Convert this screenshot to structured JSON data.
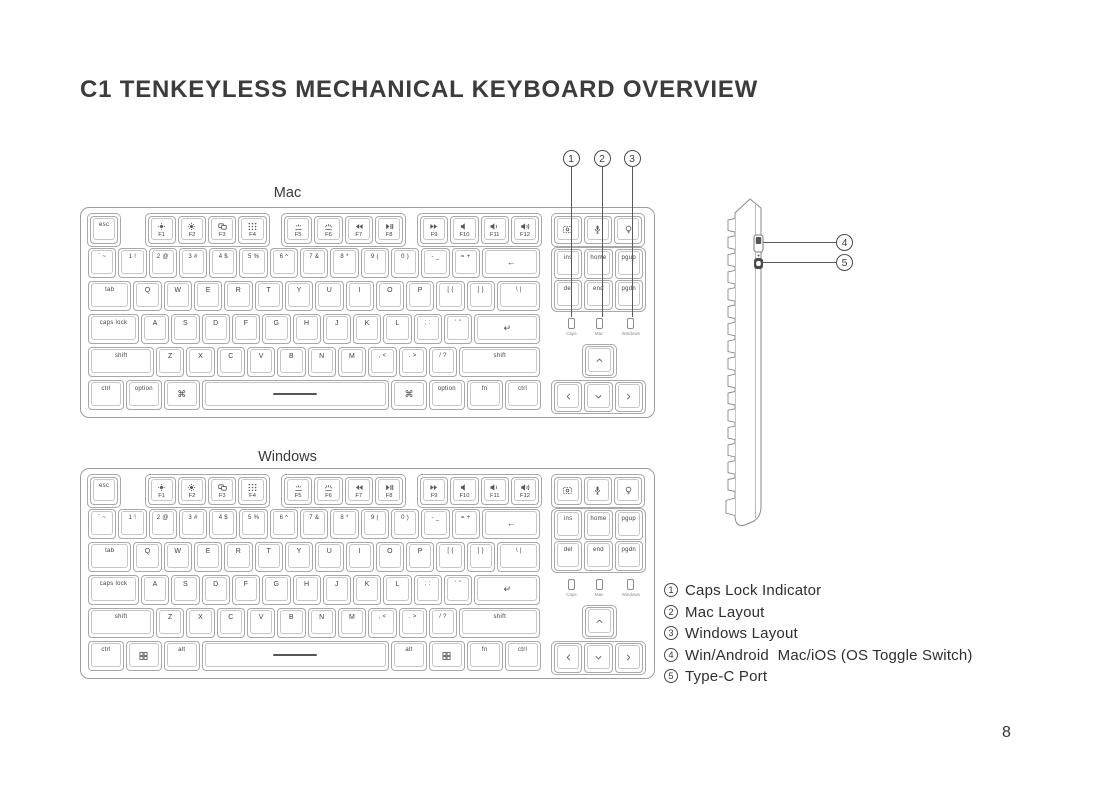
{
  "title": "C1 TENKEYLESS MECHANICAL KEYBOARD OVERVIEW",
  "page_number": "8",
  "callouts": {
    "top": [
      "1",
      "2",
      "3"
    ],
    "side": [
      "4",
      "5"
    ]
  },
  "legend": [
    {
      "num": "1",
      "text": "Caps Lock Indicator"
    },
    {
      "num": "2",
      "text": "Mac Layout"
    },
    {
      "num": "3",
      "text": "Windows Layout"
    },
    {
      "num": "4",
      "text": "Win/Android  Mac/iOS (OS Toggle Switch)"
    },
    {
      "num": "5",
      "text": "Type-C Port"
    }
  ],
  "side_view": {
    "parts": [
      "os-toggle-switch",
      "type-c-port"
    ]
  },
  "keyboards": [
    {
      "id": "mac",
      "label": "Mac",
      "fn_blocks": [
        [
          {
            "l": "esc"
          }
        ],
        [
          {
            "i": "brightness-down",
            "s": "F1"
          },
          {
            "i": "brightness-up",
            "s": "F2"
          },
          {
            "i": "mission-control",
            "s": "F3"
          },
          {
            "i": "launchpad",
            "s": "F4"
          }
        ],
        [
          {
            "i": "backlight-down",
            "s": "F5"
          },
          {
            "i": "backlight-up",
            "s": "F6"
          },
          {
            "i": "rewind",
            "s": "F7"
          },
          {
            "i": "play-pause",
            "s": "F8"
          }
        ],
        [
          {
            "i": "fast-forward",
            "s": "F9"
          },
          {
            "i": "mute",
            "s": "F10"
          },
          {
            "i": "volume-down",
            "s": "F11"
          },
          {
            "i": "volume-up",
            "s": "F12"
          }
        ],
        [
          {
            "i": "screenshot"
          },
          {
            "i": "mic"
          },
          {
            "i": "bulb"
          }
        ]
      ],
      "rows": [
        [
          {
            "l": "` ~"
          },
          {
            "l": "1 !"
          },
          {
            "l": "2 @"
          },
          {
            "l": "3 #"
          },
          {
            "l": "4 $"
          },
          {
            "l": "5 %"
          },
          {
            "l": "6 ^"
          },
          {
            "l": "7 &"
          },
          {
            "l": "8 *"
          },
          {
            "l": "9 ("
          },
          {
            "l": "0 )"
          },
          {
            "l": "- _"
          },
          {
            "l": "= +"
          },
          {
            "i": "backspace",
            "w": 2
          }
        ],
        [
          {
            "l": "tab",
            "w": 1.5
          },
          {
            "l": "Q"
          },
          {
            "l": "W"
          },
          {
            "l": "E"
          },
          {
            "l": "R"
          },
          {
            "l": "T"
          },
          {
            "l": "Y"
          },
          {
            "l": "U"
          },
          {
            "l": "I"
          },
          {
            "l": "O"
          },
          {
            "l": "P"
          },
          {
            "l": "[ {"
          },
          {
            "l": "] }"
          },
          {
            "l": "\\ |",
            "w": 1.5
          }
        ],
        [
          {
            "l": "caps lock",
            "w": 1.75
          },
          {
            "l": "A"
          },
          {
            "l": "S"
          },
          {
            "l": "D"
          },
          {
            "l": "F"
          },
          {
            "l": "G"
          },
          {
            "l": "H"
          },
          {
            "l": "J"
          },
          {
            "l": "K"
          },
          {
            "l": "L"
          },
          {
            "l": "; :"
          },
          {
            "l": "' \""
          },
          {
            "i": "enter",
            "w": 2.25
          }
        ],
        [
          {
            "l": "shift",
            "w": 2.25
          },
          {
            "l": "Z"
          },
          {
            "l": "X"
          },
          {
            "l": "C"
          },
          {
            "l": "V"
          },
          {
            "l": "B"
          },
          {
            "l": "N"
          },
          {
            "l": "M"
          },
          {
            "l": ", <"
          },
          {
            "l": ". >"
          },
          {
            "l": "/ ?"
          },
          {
            "l": "shift",
            "w": 2.75
          }
        ],
        [
          {
            "l": "ctrl",
            "w": 1.25
          },
          {
            "l": "option",
            "w": 1.25
          },
          {
            "i": "command",
            "w": 1.25
          },
          {
            "i": "space",
            "w": 6.25
          },
          {
            "i": "command",
            "w": 1.25
          },
          {
            "l": "option",
            "w": 1.25
          },
          {
            "l": "fn",
            "w": 1.25
          },
          {
            "l": "ctrl",
            "w": 1.25
          }
        ]
      ],
      "nav": [
        [
          "ins",
          "home",
          "pgup"
        ],
        [
          "del",
          "end",
          "pgdn"
        ]
      ],
      "leds": [
        "Caps",
        "Mac",
        "Windows"
      ],
      "arrows": {
        "up": "chevron-up",
        "row": [
          "chevron-left",
          "chevron-down",
          "chevron-right"
        ]
      }
    },
    {
      "id": "windows",
      "label": "Windows",
      "fn_blocks": [
        [
          {
            "l": "esc"
          }
        ],
        [
          {
            "i": "brightness-down",
            "s": "F1"
          },
          {
            "i": "brightness-up",
            "s": "F2"
          },
          {
            "i": "mission-control",
            "s": "F3"
          },
          {
            "i": "launchpad",
            "s": "F4"
          }
        ],
        [
          {
            "i": "backlight-down",
            "s": "F5"
          },
          {
            "i": "backlight-up",
            "s": "F6"
          },
          {
            "i": "rewind",
            "s": "F7"
          },
          {
            "i": "play-pause",
            "s": "F8"
          }
        ],
        [
          {
            "i": "fast-forward",
            "s": "F9"
          },
          {
            "i": "mute",
            "s": "F10"
          },
          {
            "i": "volume-down",
            "s": "F11"
          },
          {
            "i": "volume-up",
            "s": "F12"
          }
        ],
        [
          {
            "i": "screenshot"
          },
          {
            "i": "mic"
          },
          {
            "i": "bulb"
          }
        ]
      ],
      "rows": [
        [
          {
            "l": "` ~"
          },
          {
            "l": "1 !"
          },
          {
            "l": "2 @"
          },
          {
            "l": "3 #"
          },
          {
            "l": "4 $"
          },
          {
            "l": "5 %"
          },
          {
            "l": "6 ^"
          },
          {
            "l": "7 &"
          },
          {
            "l": "8 *"
          },
          {
            "l": "9 ("
          },
          {
            "l": "0 )"
          },
          {
            "l": "- _"
          },
          {
            "l": "= +"
          },
          {
            "i": "backspace",
            "w": 2
          }
        ],
        [
          {
            "l": "tab",
            "w": 1.5
          },
          {
            "l": "Q"
          },
          {
            "l": "W"
          },
          {
            "l": "E"
          },
          {
            "l": "R"
          },
          {
            "l": "T"
          },
          {
            "l": "Y"
          },
          {
            "l": "U"
          },
          {
            "l": "I"
          },
          {
            "l": "O"
          },
          {
            "l": "P"
          },
          {
            "l": "[ {"
          },
          {
            "l": "] }"
          },
          {
            "l": "\\ |",
            "w": 1.5
          }
        ],
        [
          {
            "l": "caps lock",
            "w": 1.75
          },
          {
            "l": "A"
          },
          {
            "l": "S"
          },
          {
            "l": "D"
          },
          {
            "l": "F"
          },
          {
            "l": "G"
          },
          {
            "l": "H"
          },
          {
            "l": "J"
          },
          {
            "l": "K"
          },
          {
            "l": "L"
          },
          {
            "l": "; :"
          },
          {
            "l": "' \""
          },
          {
            "i": "enter",
            "w": 2.25
          }
        ],
        [
          {
            "l": "shift",
            "w": 2.25
          },
          {
            "l": "Z"
          },
          {
            "l": "X"
          },
          {
            "l": "C"
          },
          {
            "l": "V"
          },
          {
            "l": "B"
          },
          {
            "l": "N"
          },
          {
            "l": "M"
          },
          {
            "l": ", <"
          },
          {
            "l": ". >"
          },
          {
            "l": "/ ?"
          },
          {
            "l": "shift",
            "w": 2.75
          }
        ],
        [
          {
            "l": "ctrl",
            "w": 1.25
          },
          {
            "i": "win-logo",
            "w": 1.25
          },
          {
            "l": "alt",
            "w": 1.25
          },
          {
            "i": "space",
            "w": 6.25
          },
          {
            "l": "alt",
            "w": 1.25
          },
          {
            "i": "win-logo",
            "w": 1.25
          },
          {
            "l": "fn",
            "w": 1.25
          },
          {
            "l": "ctrl",
            "w": 1.25
          }
        ]
      ],
      "nav": [
        [
          "ins",
          "home",
          "pgup"
        ],
        [
          "del",
          "end",
          "pgdn"
        ]
      ],
      "leds": [
        "Caps",
        "Mac",
        "Windows"
      ],
      "arrows": {
        "up": "chevron-up",
        "row": [
          "chevron-left",
          "chevron-down",
          "chevron-right"
        ]
      }
    }
  ]
}
